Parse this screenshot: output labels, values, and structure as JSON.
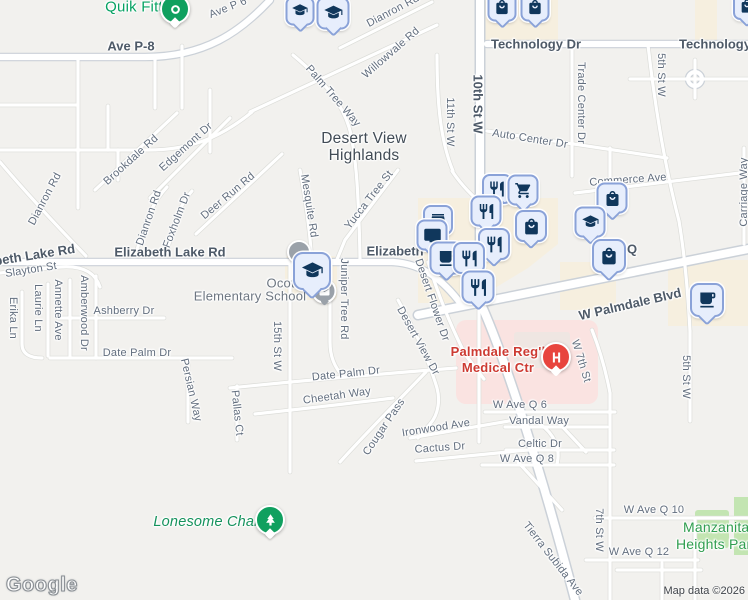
{
  "map": {
    "attribution": "Map data ©2026",
    "watermark": "Google",
    "colors": {
      "background": "#f2f1ee",
      "road_fill": "#ffffff",
      "road_casing": "#cbd1d8",
      "commercial_area": "#f6efdf",
      "hospital_area": "#fae3e1",
      "park_area": "#c3e5b2",
      "road_label": "#626e7e",
      "major_road_label": "#4e5a68",
      "marker_blue_bg": "#e7eefc",
      "marker_blue_border": "#8aa2d8",
      "marker_glyph_navy": "#10375c",
      "poi_green": "#10a05f",
      "hospital_red": "#e8453e",
      "medical_text_red": "#cd3a32",
      "park_text_green": "#2f9e4f"
    },
    "area": {
      "line1": "Desert View",
      "line2": "Highlands"
    },
    "school_label": {
      "line1": "Ocotillo",
      "line2": "Elementary School"
    },
    "hospital_label": {
      "line1": "Palmdale Reg'l",
      "line2": "Medical Ctr"
    },
    "park_label": {
      "line1": "Manzanita",
      "line2": "Heights Park"
    },
    "poi": {
      "quik_fitt": "Quik Fitt",
      "lonesome_chair": "Lonesome Chair"
    },
    "road_labels": [
      {
        "t": "Ave P 6",
        "x": 228,
        "y": 8,
        "r": -22
      },
      {
        "t": "Ave P-8",
        "x": 131,
        "y": 46,
        "r": 0,
        "c": "maj"
      },
      {
        "t": "Dianron Rd",
        "x": 393,
        "y": 11,
        "r": -28
      },
      {
        "t": "Willowvale Rd",
        "x": 391,
        "y": 53,
        "r": -41
      },
      {
        "t": "Technology Dr",
        "x": 536,
        "y": 44,
        "r": 0,
        "c": "maj"
      },
      {
        "t": "Technology Dr",
        "x": 724,
        "y": 44,
        "r": 0,
        "c": "maj"
      },
      {
        "t": "10th St W",
        "x": 478,
        "y": 104,
        "r": 90,
        "c": "maj"
      },
      {
        "t": "11th St W",
        "x": 450,
        "y": 122,
        "r": 90
      },
      {
        "t": "Trade Center Dr",
        "x": 581,
        "y": 103,
        "r": 90
      },
      {
        "t": "5th St W",
        "x": 661,
        "y": 75,
        "r": 90
      },
      {
        "t": "Auto Center Dr",
        "x": 530,
        "y": 139,
        "r": 9
      },
      {
        "t": "Commerce Ave",
        "x": 628,
        "y": 180,
        "r": -4
      },
      {
        "t": "Carriage Way",
        "x": 744,
        "y": 192,
        "r": -90
      },
      {
        "t": "Brookdale Rd",
        "x": 131,
        "y": 160,
        "r": -42
      },
      {
        "t": "Edgemont Dr",
        "x": 186,
        "y": 147,
        "r": -42
      },
      {
        "t": "Dianron Rd",
        "x": 45,
        "y": 199,
        "r": -62
      },
      {
        "t": "Dianron Rd",
        "x": 149,
        "y": 218,
        "r": -71
      },
      {
        "t": "Foxholm Dr",
        "x": 177,
        "y": 220,
        "r": -69
      },
      {
        "t": "Deer Run Rd",
        "x": 228,
        "y": 196,
        "r": -40
      },
      {
        "t": "Mesquite Rd",
        "x": 309,
        "y": 206,
        "r": 81
      },
      {
        "t": "Palm Tree Way",
        "x": 333,
        "y": 96,
        "r": 49
      },
      {
        "t": "Yucca Tree St",
        "x": 369,
        "y": 200,
        "r": -52
      },
      {
        "t": "Elizabeth Lake Rd",
        "x": 170,
        "y": 252,
        "r": 0,
        "c": "maj"
      },
      {
        "t": "Elizabeth Lake Rd",
        "x": 20,
        "y": 257,
        "r": -9,
        "c": "maj"
      },
      {
        "t": "Elizabeth",
        "x": 395,
        "y": 251,
        "r": 0,
        "c": "maj"
      },
      {
        "t": "Q",
        "x": 632,
        "y": 249,
        "r": 0,
        "c": "maj"
      },
      {
        "t": "Slayton St",
        "x": 31,
        "y": 270,
        "r": -9
      },
      {
        "t": "Erika Ln",
        "x": 13,
        "y": 318,
        "r": 90
      },
      {
        "t": "Laurie Ln",
        "x": 38,
        "y": 308,
        "r": 90
      },
      {
        "t": "Annette Ave",
        "x": 58,
        "y": 310,
        "r": 90
      },
      {
        "t": "Amberwood Dr",
        "x": 84,
        "y": 313,
        "r": 90
      },
      {
        "t": "Ashberry Dr",
        "x": 124,
        "y": 311,
        "r": 0
      },
      {
        "t": "Date Palm Dr",
        "x": 137,
        "y": 353,
        "r": 0
      },
      {
        "t": "15th St W",
        "x": 277,
        "y": 346,
        "r": 90
      },
      {
        "t": "Juniper Tree Rd",
        "x": 344,
        "y": 299,
        "r": 90
      },
      {
        "t": "Desert Flower Dr",
        "x": 432,
        "y": 300,
        "r": 71
      },
      {
        "t": "Desert View Dr",
        "x": 418,
        "y": 341,
        "r": 61
      },
      {
        "t": "Persian Way",
        "x": 191,
        "y": 390,
        "r": 77
      },
      {
        "t": "Pallas Ct",
        "x": 237,
        "y": 413,
        "r": 84
      },
      {
        "t": "Date Palm Dr",
        "x": 346,
        "y": 374,
        "r": -6
      },
      {
        "t": "Cheetah Way",
        "x": 337,
        "y": 396,
        "r": -8
      },
      {
        "t": "Cougar Pass",
        "x": 384,
        "y": 427,
        "r": -56
      },
      {
        "t": "Ironwood Ave",
        "x": 436,
        "y": 428,
        "r": -9
      },
      {
        "t": "Cactus Dr",
        "x": 440,
        "y": 448,
        "r": -4
      },
      {
        "t": "W Ave Q 6",
        "x": 520,
        "y": 405,
        "r": 0
      },
      {
        "t": "Vandal Way",
        "x": 539,
        "y": 421,
        "r": 0
      },
      {
        "t": "Celtic Dr",
        "x": 540,
        "y": 444,
        "r": 0
      },
      {
        "t": "W Ave Q 8",
        "x": 527,
        "y": 459,
        "r": 0
      },
      {
        "t": "W 7th St",
        "x": 581,
        "y": 361,
        "r": 73
      },
      {
        "t": "W Palmdale Blvd",
        "x": 630,
        "y": 304,
        "r": -13,
        "c": "maj"
      },
      {
        "t": "7th St W",
        "x": 599,
        "y": 530,
        "r": 90
      },
      {
        "t": "W Ave Q 10",
        "x": 654,
        "y": 510,
        "r": 0
      },
      {
        "t": "W Ave Q 12",
        "x": 639,
        "y": 552,
        "r": 0
      },
      {
        "t": "Tierra Subida Ave",
        "x": 553,
        "y": 559,
        "r": 52
      },
      {
        "t": "5th St W",
        "x": 686,
        "y": 377,
        "r": 90
      }
    ],
    "markers": [
      {
        "name": "school-poi-marker",
        "icon": "graduation-cap",
        "x": 300,
        "y": 11,
        "s": 25
      },
      {
        "name": "school-poi-marker",
        "icon": "graduation-cap",
        "x": 333,
        "y": 13,
        "s": 29
      },
      {
        "name": "store-poi-marker",
        "icon": "shopping-bag",
        "x": 502,
        "y": 7,
        "s": 25
      },
      {
        "name": "store-poi-marker",
        "icon": "shopping-bag",
        "x": 535,
        "y": 7,
        "s": 25
      },
      {
        "name": "store-poi-marker",
        "icon": "shopping-bag",
        "x": 747,
        "y": 6,
        "s": 24
      },
      {
        "name": "poi-dot-marker",
        "icon": "dot",
        "x": 299,
        "y": 252,
        "s": 20,
        "v": "gray"
      },
      {
        "name": "post-poi-marker",
        "icon": "envelope",
        "x": 324,
        "y": 291,
        "s": 21,
        "v": "gray"
      },
      {
        "name": "ocotillo-school-marker",
        "icon": "graduation-cap",
        "x": 312,
        "y": 271,
        "s": 34
      },
      {
        "name": "restaurant-poi-marker",
        "icon": "restaurant",
        "x": 497,
        "y": 189,
        "s": 26
      },
      {
        "name": "grocery-poi-marker",
        "icon": "shopping-cart",
        "x": 523,
        "y": 190,
        "s": 27
      },
      {
        "name": "restaurant-poi-marker",
        "icon": "restaurant",
        "x": 486,
        "y": 211,
        "s": 27
      },
      {
        "name": "store-poi-marker",
        "icon": "shopping-bag",
        "x": 531,
        "y": 226,
        "s": 28
      },
      {
        "name": "store-poi-marker",
        "icon": "storefront",
        "x": 438,
        "y": 220,
        "s": 26
      },
      {
        "name": "electronics-poi-marker",
        "icon": "tv",
        "x": 432,
        "y": 235,
        "s": 27
      },
      {
        "name": "restaurant-poi-marker",
        "icon": "restaurant",
        "x": 494,
        "y": 244,
        "s": 28
      },
      {
        "name": "cafe-poi-marker",
        "icon": "cafe",
        "x": 446,
        "y": 258,
        "s": 29
      },
      {
        "name": "restaurant-poi-marker",
        "icon": "restaurant",
        "x": 469,
        "y": 258,
        "s": 28
      },
      {
        "name": "restaurant-poi-marker",
        "icon": "restaurant",
        "x": 478,
        "y": 287,
        "s": 29
      },
      {
        "name": "store-poi-marker",
        "icon": "shopping-bag",
        "x": 612,
        "y": 198,
        "s": 27
      },
      {
        "name": "school-poi-marker",
        "icon": "graduation-cap",
        "x": 590,
        "y": 222,
        "s": 27
      },
      {
        "name": "store-poi-marker",
        "icon": "shopping-bag",
        "x": 609,
        "y": 256,
        "s": 30
      },
      {
        "name": "cafe-poi-marker",
        "icon": "cafe",
        "x": 707,
        "y": 300,
        "s": 30
      },
      {
        "name": "hospital-marker",
        "icon": "hospital-h",
        "x": 556,
        "y": 357,
        "s": 26,
        "v": "red"
      },
      {
        "name": "quik-fitt-marker",
        "icon": "ring",
        "x": 175,
        "y": 9,
        "s": 26,
        "v": "green"
      },
      {
        "name": "lonesome-chair-marker",
        "icon": "tree",
        "x": 270,
        "y": 520,
        "s": 26,
        "v": "green"
      }
    ]
  }
}
